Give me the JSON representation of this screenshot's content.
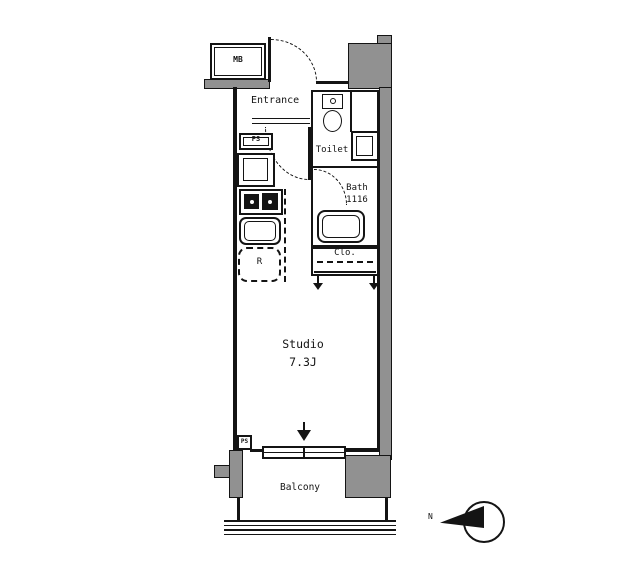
{
  "colors": {
    "wall_fill": "#919191",
    "line": "#141414",
    "background": "#ffffff"
  },
  "labels": {
    "meter_box": "MB",
    "entrance": "Entrance",
    "toilet": "Toilet",
    "bath": "Bath",
    "bath_size": "1116",
    "closet": "Clo.",
    "studio": "Studio",
    "studio_size": "7.3J",
    "balcony": "Balcony",
    "pipe_space_kitchen": "PS",
    "pipe_space_window": "PS",
    "refrigerator": "R",
    "compass_north": "N"
  }
}
